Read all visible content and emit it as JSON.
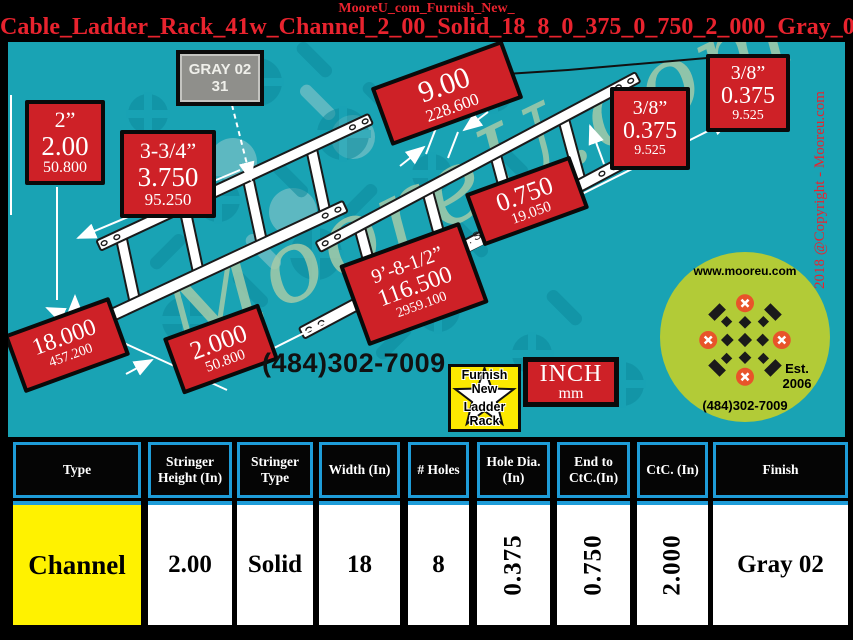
{
  "header": {
    "line1": "MooreU_com_Furnish_New_",
    "line2": "Cable_Ladder_Rack_41w_Channel_2_00_Solid_18_8_0_375_0_750_2_000_Gray_02"
  },
  "diagram": {
    "gray_label": {
      "line1": "GRAY 02",
      "line2": "31"
    },
    "material_note": "Material : Steel",
    "watermark": "MooreU.com",
    "copyright": "2018 @Copyright - Mooreu.com",
    "phone": "(484)302-7009",
    "units": {
      "primary": "INCH",
      "secondary": "mm"
    },
    "badge": {
      "line1": "Furnish",
      "line2": "New",
      "line3": "Ladder",
      "line4": "Rack"
    },
    "logo": {
      "website": "www.mooreu.com",
      "est_line1": "Est.",
      "est_line2": "2006",
      "phone": "(484)302-7009"
    },
    "labels": [
      {
        "fraction": "2”",
        "inches": "2.00",
        "mm": "50.800"
      },
      {
        "fraction": "3-3/4”",
        "inches": "3.750",
        "mm": "95.250"
      },
      {
        "inches": "9.00",
        "mm": "228.600"
      },
      {
        "fraction": "3/8”",
        "inches": "0.375",
        "mm": "9.525"
      },
      {
        "fraction": "3/8”",
        "inches": "0.375",
        "mm": "9.525"
      },
      {
        "inches": "0.750",
        "mm": "19.050"
      },
      {
        "fraction": "9’-8-1/2”",
        "inches": "116.500",
        "mm": "2959.100"
      },
      {
        "inches": "18.000",
        "mm": "457.200"
      },
      {
        "inches": "2.000",
        "mm": "50.800"
      }
    ]
  },
  "table": {
    "headers": [
      "Type",
      "Stringer Height (In)",
      "Stringer Type",
      "Width (In)",
      "# Holes",
      "Hole Dia. (In)",
      "End to CtC.(In)",
      "CtC. (In)",
      "Finish"
    ],
    "row": [
      "Channel",
      "2.00",
      "Solid",
      "18",
      "8",
      "0.375",
      "0.750",
      "2.000",
      "Gray 02"
    ]
  },
  "colors": {
    "background": "#000000",
    "panel_teal": "#19a3b4",
    "label_red": "#ce2127",
    "title_red": "#e8232e",
    "table_border_blue": "#1e9cd8",
    "highlight_yellow": "#fff200",
    "logo_green": "#b2cb37",
    "watermark_green": "#a5cba8"
  }
}
